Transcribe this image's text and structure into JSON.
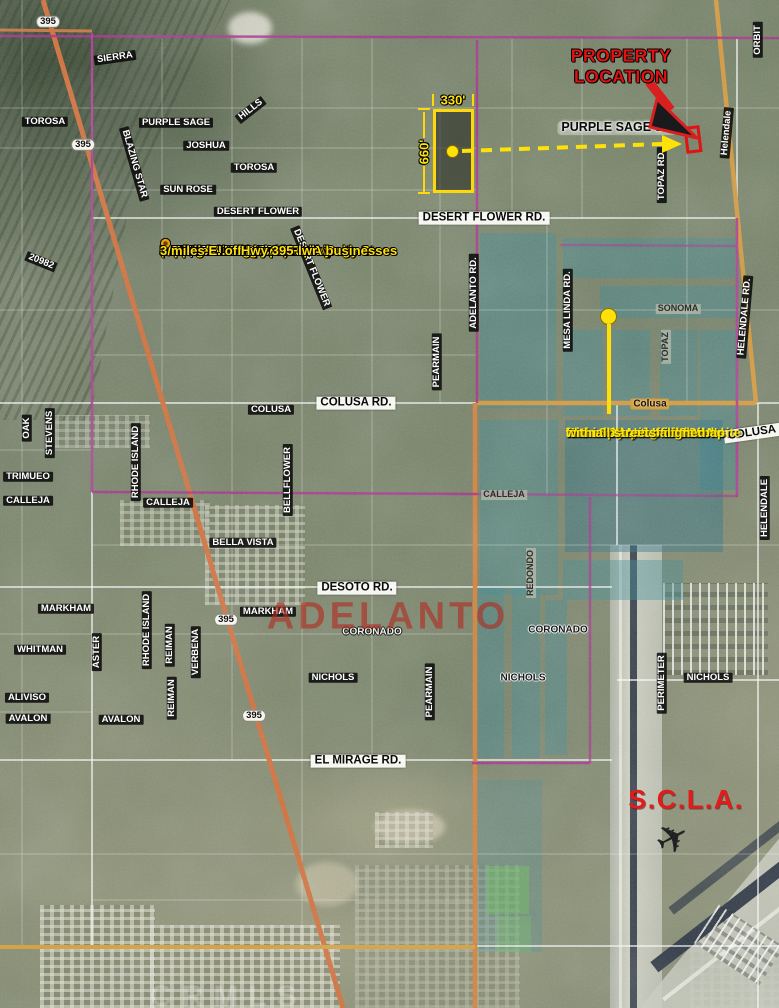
{
  "annotations": {
    "property_location_line1": "PROPERTY",
    "property_location_line2": "LOCATION",
    "city_label": "ADELANTO",
    "airport_label": "S.C.L.A.",
    "dim_width": "330'",
    "dim_height": "660'",
    "watermark": "CRMLS",
    "accent_colors": {
      "highlight_yellow": "#FFE10A",
      "alert_red": "#E01212",
      "boundary_magenta": "#AA3390",
      "highway_orange": "#D4713B",
      "blueprint_teal": "#3A8C98"
    },
    "bullets": [
      {
        "parts": [
          {
            "t": "SIZE: ",
            "c": "y"
          },
          {
            "t": "5 ACRES",
            "c": "w"
          },
          {
            "t": "  (Approx: 330' x 660')",
            "c": "y"
          }
        ]
      },
      {
        "parts": [
          {
            "t": "ZONING: DL-9 (Residential)",
            "c": "y"
          }
        ]
      },
      {
        "parts": [
          {
            "t": "PRICE: ",
            "c": "y"
          },
          {
            "t": "$225,000",
            "c": "w"
          }
        ]
      },
      {
        "parts": [
          {
            "t": "Zoning is being updated by city",
            "c": "y"
          }
        ]
      },
      {
        "parts": [
          {
            "t": "330' of frontage on Purple Sage St.",
            "c": "y"
          }
        ]
      },
      {
        "parts": [
          {
            "t": "1/2 mile N. of future SCLA businesses",
            "c": "y"
          }
        ]
      },
      {
        "parts": [
          {
            "t": "660' W. of Helendale Rd.",
            "c": "y"
          }
        ]
      },
      {
        "parts": [
          {
            "t": "1/2 mile N. of Desert Flwr",
            "c": "y"
          }
        ]
      },
      {
        "parts": [
          {
            "t": "3 miles E. of Hwy 395",
            "c": "y"
          }
        ]
      }
    ],
    "note_lines": [
      "The overlaying artwork",
      "is the blueprint of SCLA's",
      "future layout.  It is otained",
      "from SCLA's official website",
      "and is placed on this map",
      "with all streets aligned."
    ]
  },
  "street_labels": [
    {
      "t": "SIERRA",
      "x": 115,
      "y": 58,
      "r": -8,
      "s": "dark"
    },
    {
      "t": "TOROSA",
      "x": 45,
      "y": 122,
      "r": 0,
      "s": "dark"
    },
    {
      "t": "PURPLE SAGE",
      "x": 176,
      "y": 123,
      "r": 0,
      "s": "dark"
    },
    {
      "t": "JOSHUA",
      "x": 206,
      "y": 146,
      "r": 0,
      "s": "dark"
    },
    {
      "t": "HILLS",
      "x": 251,
      "y": 110,
      "r": -38,
      "s": "dark"
    },
    {
      "t": "TOROSA",
      "x": 254,
      "y": 168,
      "r": 0,
      "s": "dark"
    },
    {
      "t": "SUN ROSE",
      "x": 188,
      "y": 190,
      "r": 0,
      "s": "dark"
    },
    {
      "t": "DESERT FLOWER",
      "x": 258,
      "y": 212,
      "r": 0,
      "s": "dark"
    },
    {
      "t": "BLAZING STAR",
      "x": 134,
      "y": 164,
      "r": 74,
      "s": "dark"
    },
    {
      "t": "20982",
      "x": 41,
      "y": 262,
      "r": 22,
      "s": "dark"
    },
    {
      "t": "DESERT FLOWER",
      "x": 311,
      "y": 268,
      "r": 68,
      "s": "dark"
    },
    {
      "t": "395",
      "x": 48,
      "y": 22,
      "r": 0,
      "s": "shield"
    },
    {
      "t": "395",
      "x": 83,
      "y": 145,
      "r": 0,
      "s": "shield"
    },
    {
      "t": "395",
      "x": 226,
      "y": 620,
      "r": 0,
      "s": "shield"
    },
    {
      "t": "395",
      "x": 254,
      "y": 716,
      "r": 0,
      "s": "shield"
    },
    {
      "t": "OAK",
      "x": 27,
      "y": 428,
      "r": -90,
      "s": "dark"
    },
    {
      "t": "STEVENS",
      "x": 50,
      "y": 433,
      "r": -90,
      "s": "dark"
    },
    {
      "t": "RHODE ISLAND",
      "x": 136,
      "y": 462,
      "r": -90,
      "s": "dark"
    },
    {
      "t": "TRIMUEO",
      "x": 28,
      "y": 477,
      "r": 0,
      "s": "dark"
    },
    {
      "t": "CALLEJA",
      "x": 28,
      "y": 501,
      "r": 0,
      "s": "dark"
    },
    {
      "t": "CALLEJA",
      "x": 168,
      "y": 503,
      "r": 0,
      "s": "dark"
    },
    {
      "t": "COLUSA",
      "x": 271,
      "y": 410,
      "r": 0,
      "s": "dark"
    },
    {
      "t": "BELLFLOWER",
      "x": 288,
      "y": 480,
      "r": -90,
      "s": "dark"
    },
    {
      "t": "BELLA VISTA",
      "x": 243,
      "y": 543,
      "r": 0,
      "s": "dark"
    },
    {
      "t": "ADELANTO RD.",
      "x": 474,
      "y": 293,
      "r": -90,
      "s": "dark"
    },
    {
      "t": "PEARMAIN",
      "x": 437,
      "y": 362,
      "r": -90,
      "s": "dark"
    },
    {
      "t": "MESA LINDA RD.",
      "x": 568,
      "y": 310,
      "r": -90,
      "s": "dark"
    },
    {
      "t": "TOPAZ RD.",
      "x": 662,
      "y": 175,
      "r": -90,
      "s": "dark"
    },
    {
      "t": "TOPAZ",
      "x": 666,
      "y": 347,
      "r": -90,
      "s": "ghost"
    },
    {
      "t": "SONOMA",
      "x": 678,
      "y": 309,
      "r": 0,
      "s": "ghost"
    },
    {
      "t": "ORBIT",
      "x": 758,
      "y": 40,
      "r": -90,
      "s": "dark"
    },
    {
      "t": "Helendale",
      "x": 727,
      "y": 133,
      "r": -85,
      "s": "dark"
    },
    {
      "t": "HELENDALE RD.",
      "x": 745,
      "y": 317,
      "r": -85,
      "s": "dark"
    },
    {
      "t": "HELENDALE",
      "x": 765,
      "y": 508,
      "r": -90,
      "s": "dark"
    },
    {
      "t": "COLUSA",
      "x": 752,
      "y": 433,
      "r": -8,
      "s": "light"
    },
    {
      "t": "Colusa",
      "x": 650,
      "y": 404,
      "r": 0,
      "s": "onroad"
    },
    {
      "t": "CALLEJA",
      "x": 504,
      "y": 495,
      "r": 0,
      "s": "ghost"
    },
    {
      "t": "REDONDO",
      "x": 531,
      "y": 573,
      "r": -90,
      "s": "ghost"
    },
    {
      "t": "MARKHAM",
      "x": 66,
      "y": 609,
      "r": 0,
      "s": "dark"
    },
    {
      "t": "MARKHAM",
      "x": 268,
      "y": 612,
      "r": 0,
      "s": "dark"
    },
    {
      "t": "CORONADO",
      "x": 372,
      "y": 632,
      "r": 0,
      "s": "outline-white"
    },
    {
      "t": "CORONADO",
      "x": 558,
      "y": 630,
      "r": 0,
      "s": "outline-black"
    },
    {
      "t": "RHODE ISLAND",
      "x": 147,
      "y": 630,
      "r": -90,
      "s": "dark"
    },
    {
      "t": "REIMAN",
      "x": 170,
      "y": 645,
      "r": -90,
      "s": "dark"
    },
    {
      "t": "VERBENA",
      "x": 196,
      "y": 652,
      "r": -90,
      "s": "dark"
    },
    {
      "t": "REIMAN",
      "x": 172,
      "y": 698,
      "r": -90,
      "s": "dark"
    },
    {
      "t": "WHITMAN",
      "x": 40,
      "y": 650,
      "r": 0,
      "s": "dark"
    },
    {
      "t": "ASTER",
      "x": 97,
      "y": 652,
      "r": -90,
      "s": "dark"
    },
    {
      "t": "ALIVISO",
      "x": 27,
      "y": 698,
      "r": 0,
      "s": "dark"
    },
    {
      "t": "AVALON",
      "x": 28,
      "y": 719,
      "r": 0,
      "s": "dark"
    },
    {
      "t": "AVALON",
      "x": 121,
      "y": 720,
      "r": 0,
      "s": "dark"
    },
    {
      "t": "NICHOLS",
      "x": 333,
      "y": 678,
      "r": 0,
      "s": "dark"
    },
    {
      "t": "NICHOLS",
      "x": 523,
      "y": 678,
      "r": 0,
      "s": "outline-black"
    },
    {
      "t": "NICHOLS",
      "x": 708,
      "y": 678,
      "r": 0,
      "s": "dark"
    },
    {
      "t": "PEARMAIN",
      "x": 430,
      "y": 692,
      "r": -90,
      "s": "dark"
    },
    {
      "t": "PERIMETER",
      "x": 662,
      "y": 683,
      "r": -90,
      "s": "dark"
    },
    {
      "t": "DESERT FLOWER RD.",
      "x": 484,
      "y": 218,
      "r": 0,
      "s": "light"
    },
    {
      "t": "COLUSA RD.",
      "x": 356,
      "y": 403,
      "r": 0,
      "s": "light"
    },
    {
      "t": "DESOTO RD.",
      "x": 357,
      "y": 588,
      "r": 0,
      "s": "light"
    },
    {
      "t": "EL MIRAGE RD.",
      "x": 358,
      "y": 761,
      "r": 0,
      "s": "light"
    },
    {
      "t": "PURPLE SAGE ST.",
      "x": 617,
      "y": 128,
      "r": 0,
      "s": "halo"
    }
  ]
}
